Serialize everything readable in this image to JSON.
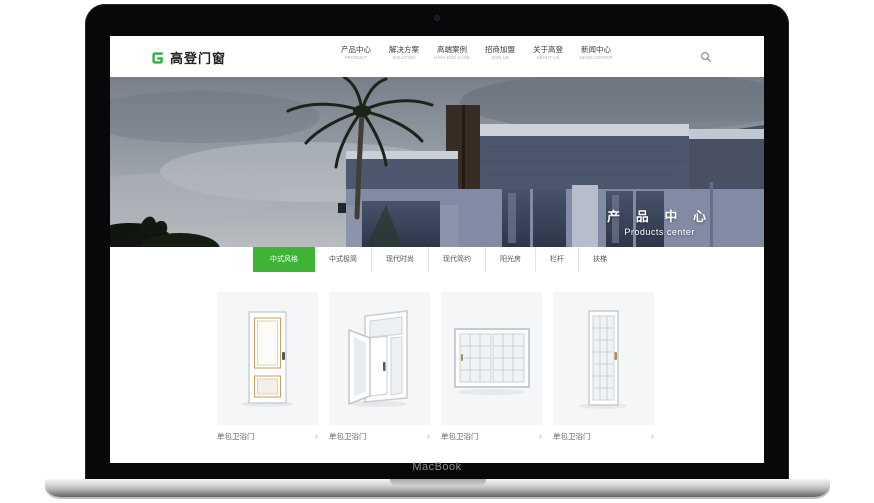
{
  "device": {
    "label": "MacBook"
  },
  "colors": {
    "accent_green": "#3eb335",
    "logo_green": "#2eb13a"
  },
  "header": {
    "logo_text": "高登门窗",
    "logo_icon": "green-g-icon",
    "nav": [
      {
        "zh": "产品中心",
        "en": "PRODUCT"
      },
      {
        "zh": "解决方案",
        "en": "SOLUTION"
      },
      {
        "zh": "高端案例",
        "en": "HIGH-END CASE"
      },
      {
        "zh": "招商加盟",
        "en": "JOIN US"
      },
      {
        "zh": "关于高登",
        "en": "ABOUT US"
      },
      {
        "zh": "新闻中心",
        "en": "NEWS CENTER"
      }
    ],
    "search_icon": "magnifier"
  },
  "hero": {
    "title_zh": "产 品 中 心",
    "title_en": "Products center"
  },
  "tabs": {
    "active_index": 0,
    "items": [
      "中式风格",
      "中式极简",
      "现代时尚",
      "现代简约",
      "阳光房",
      "栏杆",
      "扶梯"
    ]
  },
  "products": {
    "arrow": "›",
    "items": [
      {
        "label": "单包卫浴门",
        "image": "panel-door"
      },
      {
        "label": "单包卫浴门",
        "image": "open-casement-window"
      },
      {
        "label": "单包卫浴门",
        "image": "sliding-grid-window"
      },
      {
        "label": "单包卫浴门",
        "image": "grid-glass-door"
      }
    ]
  }
}
